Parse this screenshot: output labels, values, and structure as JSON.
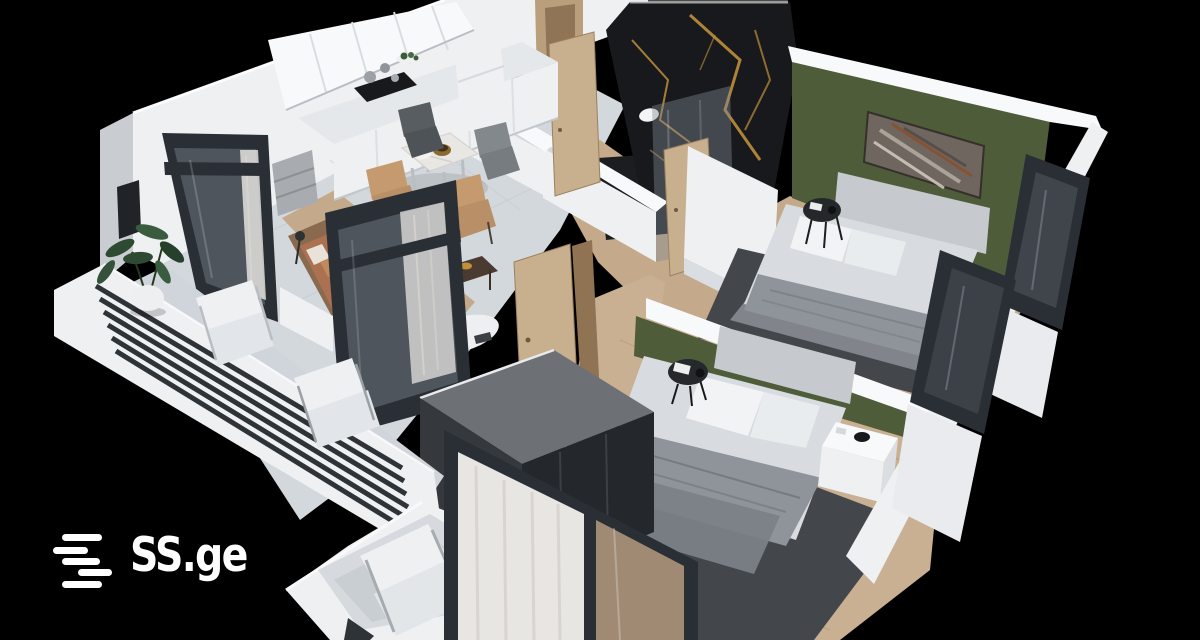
{
  "watermark": {
    "brand": "SS.ge",
    "icon": "ss-ge-stacked-bars-logo"
  },
  "colors": {
    "background": "#000000",
    "logo": "#ffffff",
    "wall": "#eef0f2",
    "green": "#4f5c39",
    "marble": "#17191c",
    "gold": "#bf8f3c",
    "wood": "#c4aa8b",
    "tile": "#d3d8dd",
    "rug": "#43474c",
    "frame": "#2a2f35",
    "bedding": "#d8dbdf",
    "door": "#c8b08e"
  }
}
